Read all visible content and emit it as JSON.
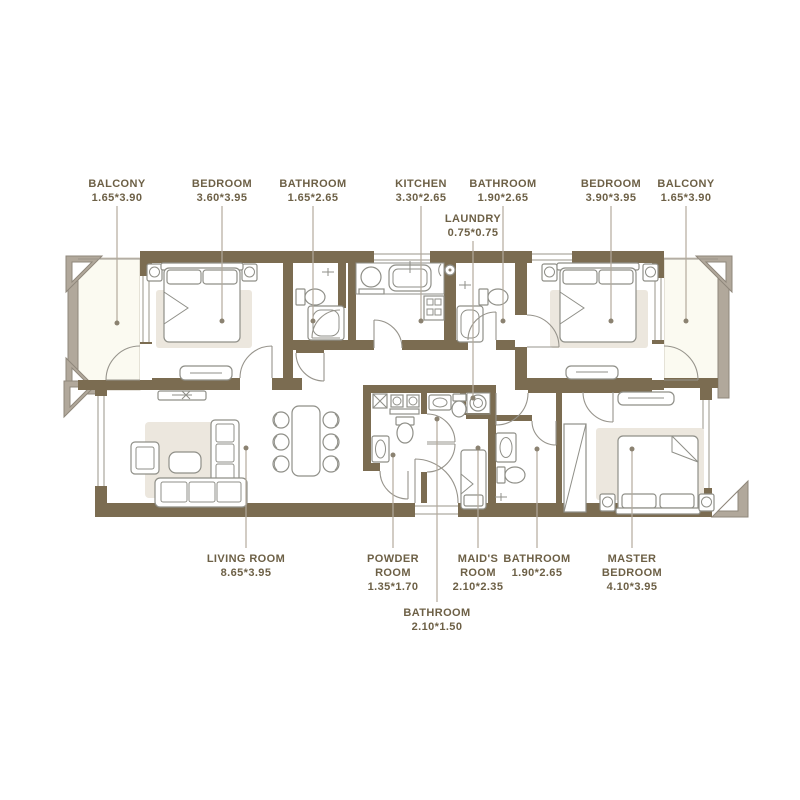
{
  "title": "Apartment floor plan",
  "colors": {
    "wall": "#7b6c51",
    "rail": "#b1a89b",
    "label": "#6d6046",
    "rug": "#ece7de",
    "balcony": "#fbfaf1",
    "leader": "#b3aa9c",
    "bg": "#ffffff"
  },
  "labels": {
    "top": [
      {
        "id": "balcony-left",
        "lines": [
          "BALCONY"
        ],
        "dims": "1.65*3.90"
      },
      {
        "id": "bedroom-left",
        "lines": [
          "BEDROOM"
        ],
        "dims": "3.60*3.95"
      },
      {
        "id": "bathroom-top-left",
        "lines": [
          "BATHROOM"
        ],
        "dims": "1.65*2.65"
      },
      {
        "id": "kitchen",
        "lines": [
          "KITCHEN"
        ],
        "dims": "3.30*2.65"
      },
      {
        "id": "laundry",
        "lines": [
          "LAUNDRY"
        ],
        "dims": "0.75*0.75"
      },
      {
        "id": "bathroom-top-right",
        "lines": [
          "BATHROOM"
        ],
        "dims": "1.90*2.65"
      },
      {
        "id": "bedroom-right",
        "lines": [
          "BEDROOM"
        ],
        "dims": "3.90*3.95"
      },
      {
        "id": "balcony-right",
        "lines": [
          "BALCONY"
        ],
        "dims": "1.65*3.90"
      }
    ],
    "bottom": [
      {
        "id": "living-room",
        "lines": [
          "LIVING ROOM"
        ],
        "dims": "8.65*3.95"
      },
      {
        "id": "powder-room",
        "lines": [
          "POWDER",
          "ROOM"
        ],
        "dims": "1.35*1.70"
      },
      {
        "id": "bathroom-bottom-middle",
        "lines": [
          "BATHROOM"
        ],
        "dims": "2.10*1.50"
      },
      {
        "id": "maids-room",
        "lines": [
          "MAID'S",
          "ROOM"
        ],
        "dims": "2.10*2.35"
      },
      {
        "id": "bathroom-bottom-right",
        "lines": [
          "BATHROOM"
        ],
        "dims": "1.90*2.65"
      },
      {
        "id": "master-bedroom",
        "lines": [
          "MASTER",
          "BEDROOM"
        ],
        "dims": "4.10*3.95"
      }
    ]
  }
}
